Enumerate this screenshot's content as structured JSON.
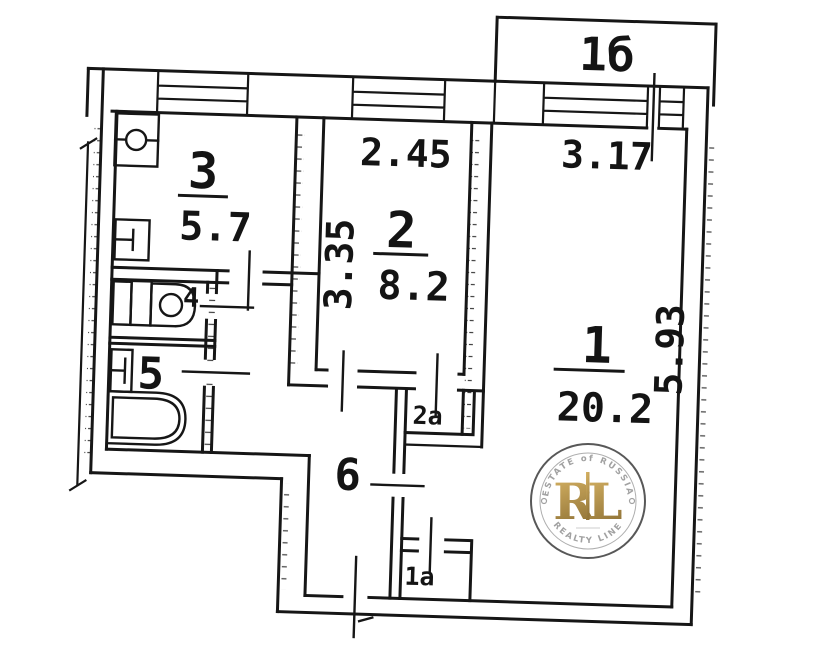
{
  "plan": {
    "balcony": {
      "label": "1б"
    },
    "room1": {
      "number": "1",
      "area": "20.2",
      "width_m": "3.17",
      "height_m": "5.93"
    },
    "room2": {
      "number": "2",
      "area": "8.2",
      "width_m": "2.45",
      "height_m": "3.35"
    },
    "room3": {
      "number": "3",
      "area": "5.7"
    },
    "room4": {
      "number": "4"
    },
    "room5": {
      "number": "5"
    },
    "room6": {
      "number": "6"
    },
    "closet_2a": {
      "label": "2а"
    },
    "closet_1a": {
      "label": "1а"
    }
  },
  "watermark": {
    "arc_top": "ESTATE of RUSSIA",
    "monogram_r": "R",
    "monogram_l": "L",
    "arc_bottom": "REALTY LINE",
    "gold": "#b8913d",
    "ring": "#4a4a4a"
  },
  "colors": {
    "ink": "#161616",
    "paper": "#ffffff"
  }
}
